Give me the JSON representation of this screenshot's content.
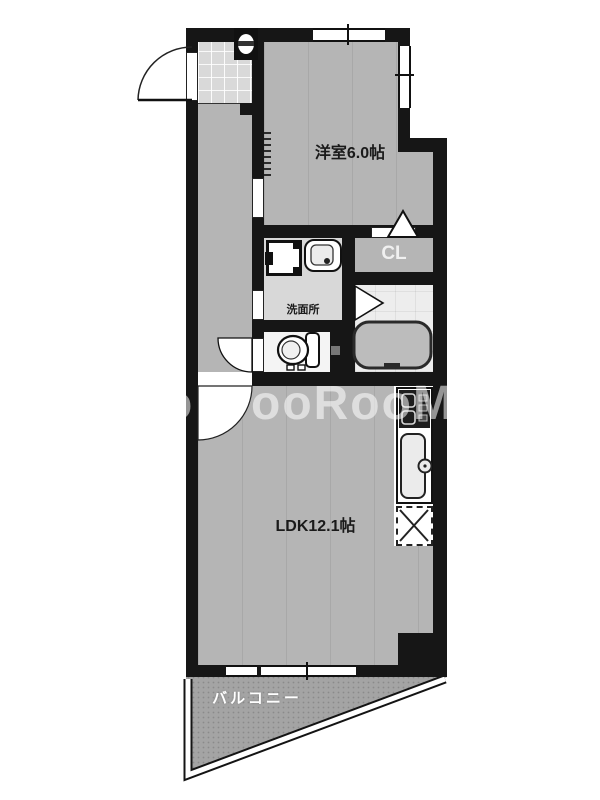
{
  "rooms": {
    "western_room": "洋室6.0帖",
    "ldk": "LDK12.1帖",
    "washroom": "洗面所",
    "closet": "CL",
    "balcony": "バルコニー"
  },
  "watermark": {
    "fragment": "o",
    "text": "ooRooM"
  },
  "icons": {
    "entrance_door": "quarter-circle swing arc",
    "room_door": "quarter-circle swing arc",
    "closet_door": "triangle-up marker",
    "bath_door": "triangle-right marker",
    "sliding_door": "tick track strip",
    "alarm_box": "small white unit in wall",
    "washing_machine_pan": "square pan with faucet tab",
    "washbasin": "rounded basin with drain dot",
    "toilet": "tank and bowl",
    "bathtub": "rounded rectangle tub",
    "stove": "dark panel with burners",
    "kitchen_sink": "counter sink with faucet circle",
    "refrigerator_space": "dashed box with X",
    "window": "white band with tick",
    "balcony_railing": "white double-line band"
  },
  "colors": {
    "wall": "#161616",
    "floor": "#b5b5b5",
    "light_floor": "#d8d8d8",
    "bath_floor": "#ededed",
    "balcony_floor": "#a4a4a4",
    "watermark": "rgba(255,255,255,0.55)"
  }
}
